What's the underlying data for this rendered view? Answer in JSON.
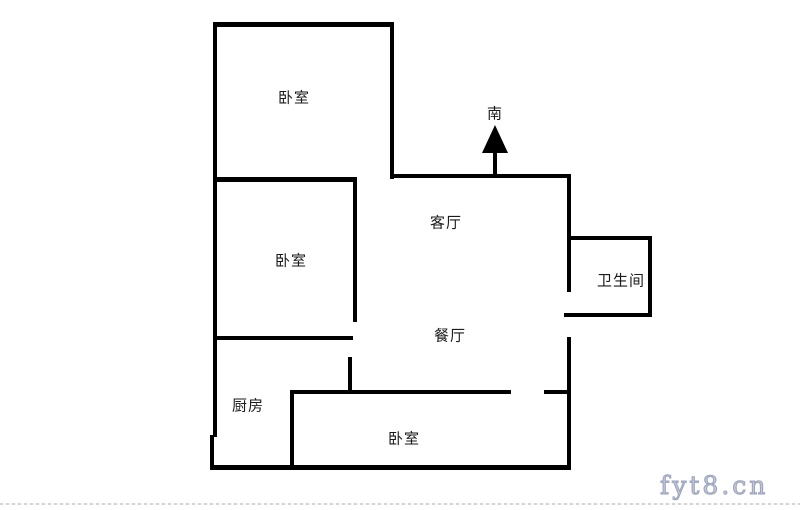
{
  "page": {
    "background_color": "#ffffff"
  },
  "floorplan": {
    "wall_color": "#000000",
    "rooms": {
      "bedroom_top": "卧室",
      "bedroom_mid": "卧室",
      "living": "客厅",
      "bathroom": "卫生间",
      "dining": "餐厅",
      "kitchen": "厨房",
      "bedroom_bottom": "卧室"
    },
    "compass": {
      "label": "南",
      "direction": "up"
    },
    "walls": [
      {
        "name": "wall-outer-top",
        "x": 213,
        "y": 22,
        "w": 181,
        "h": 5
      },
      {
        "name": "wall-outer-left-upper",
        "x": 213,
        "y": 22,
        "w": 4,
        "h": 415
      },
      {
        "name": "wall-outer-left-lower",
        "x": 210,
        "y": 435,
        "w": 4,
        "h": 35
      },
      {
        "name": "wall-outer-bottom",
        "x": 210,
        "y": 465,
        "w": 361,
        "h": 5
      },
      {
        "name": "wall-bedroom-top-right",
        "x": 390,
        "y": 22,
        "w": 4,
        "h": 157
      },
      {
        "name": "wall-living-top",
        "x": 390,
        "y": 174,
        "w": 181,
        "h": 4
      },
      {
        "name": "wall-right-upper-bath-left",
        "x": 567,
        "y": 174,
        "w": 4,
        "h": 118
      },
      {
        "name": "wall-bathroom-top",
        "x": 567,
        "y": 236,
        "w": 85,
        "h": 4
      },
      {
        "name": "wall-bathroom-right",
        "x": 648,
        "y": 236,
        "w": 4,
        "h": 81
      },
      {
        "name": "wall-bathroom-bottom",
        "x": 564,
        "y": 313,
        "w": 88,
        "h": 4
      },
      {
        "name": "wall-outer-right-lower",
        "x": 567,
        "y": 337,
        "w": 4,
        "h": 133
      },
      {
        "name": "wall-bedroom-divider",
        "x": 213,
        "y": 177,
        "w": 144,
        "h": 5
      },
      {
        "name": "wall-bedroom-mid-right",
        "x": 353,
        "y": 177,
        "w": 4,
        "h": 145
      },
      {
        "name": "wall-bedroom-mid-bottom",
        "x": 213,
        "y": 336,
        "w": 140,
        "h": 4
      },
      {
        "name": "wall-kitchen-divider",
        "x": 348,
        "y": 357,
        "w": 4,
        "h": 36
      },
      {
        "name": "wall-bedroom-bottom-top",
        "x": 290,
        "y": 390,
        "w": 221,
        "h": 4
      },
      {
        "name": "wall-bedroom-bottom-top-right",
        "x": 544,
        "y": 390,
        "w": 25,
        "h": 4
      },
      {
        "name": "wall-bedroom-bottom-left",
        "x": 290,
        "y": 390,
        "w": 4,
        "h": 78
      }
    ]
  },
  "watermark": {
    "text": "fyt8.cn",
    "color": "#c2c8d8"
  }
}
